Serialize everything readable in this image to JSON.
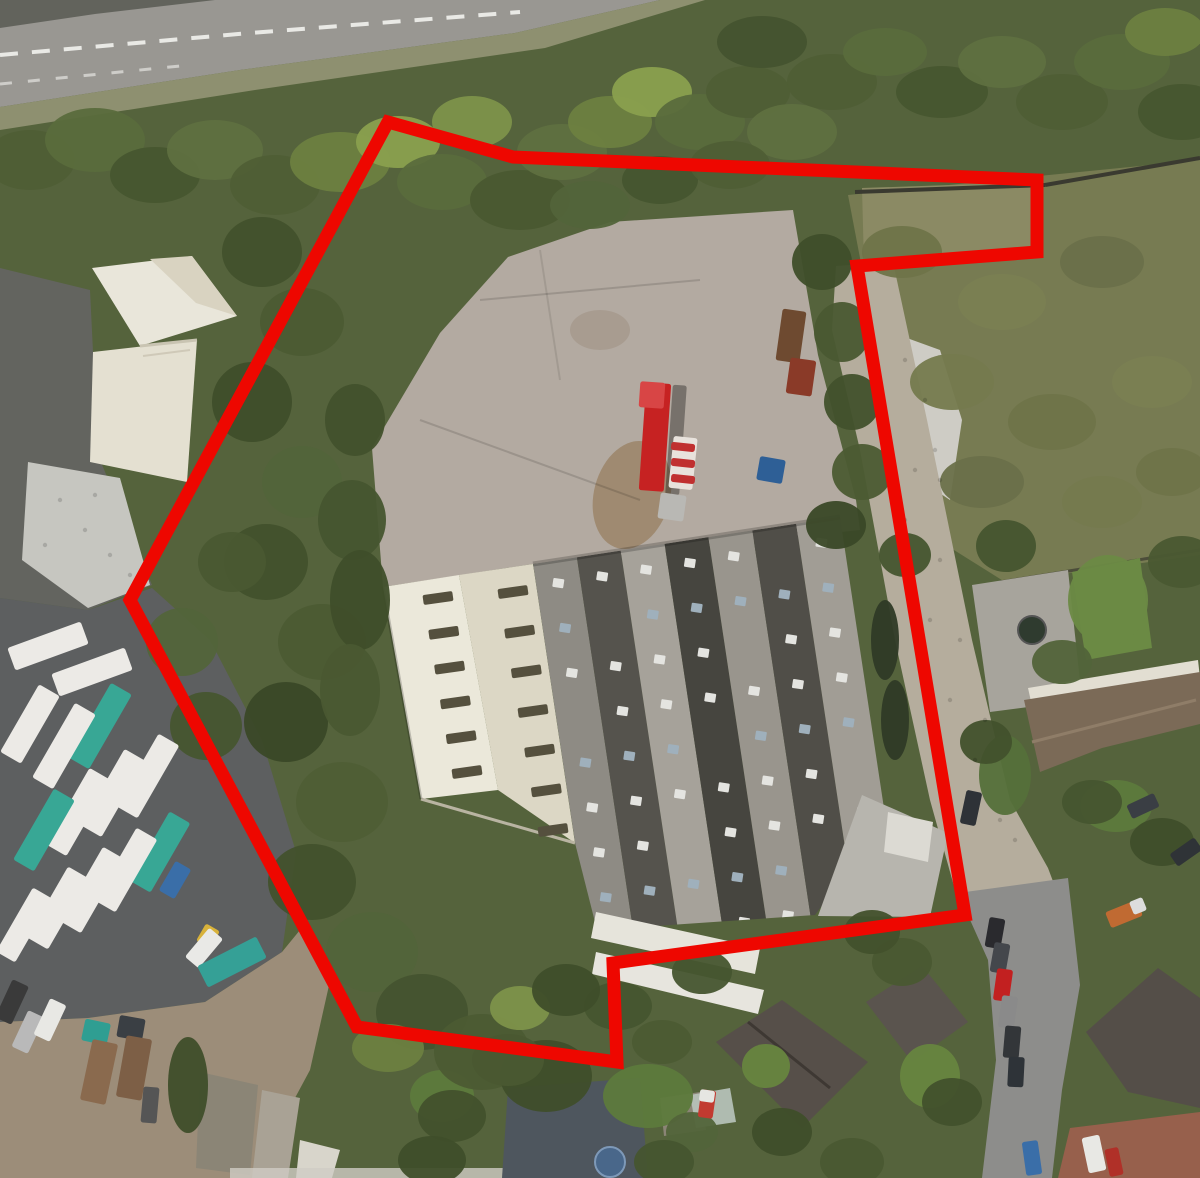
{
  "image": {
    "width": 1200,
    "height": 1178,
    "description": "Aerial satellite photograph of an industrial site with a large warehouse, concrete yard, truck depot and surrounding houses, outlined by a thick red site boundary polygon"
  },
  "colors": {
    "boundary": "#ee0700",
    "veg_base": "#55633c",
    "road": "#999792",
    "road_median": "#62635c",
    "verge": "#8e9070",
    "lane_marking": "#f2f2ee",
    "yard_concrete": "#b3aaa1",
    "yard_dirt": "#9b8569",
    "scrub": "#777b52",
    "notch_scrub": "#8b8a64",
    "wall_dark": "#3a3a30",
    "debris": "#ceccc5",
    "white_building": "#e9e6da",
    "white_building_shade": "#d9d3c1",
    "white_building_wing": "#e4e0d1",
    "asphalt_dark": "#63645f",
    "gravel": "#c6c6c0",
    "depot_ground": "#5d5f60",
    "dirt_yard": "#9c8d79",
    "cream_roof_1": "#ebe8da",
    "cream_roof_2": "#dcd7c5",
    "roof_vent": "#55503e",
    "annex_roof": "#b7b5ae",
    "annex_white": "#dcdad3",
    "awning_white": "#e6e4db",
    "driveway_cobble": "#b5ad9d",
    "right_road": "#8d8d8b",
    "patio": "#a7a49c",
    "lawn": "#6b8a44",
    "terrace_facade": "#e2ded2",
    "terrace_roof": "#7b6a57",
    "house_dark": "#564f49",
    "house_dark2": "#5a544e",
    "house_dark3": "#544e48",
    "house_blue": "#4e565e",
    "brown_roof": "#97604c",
    "white_walls": "#e7e5de",
    "shed": "#8b8576",
    "truck_white": "#eceae6",
    "truck_teal": "#38a795",
    "red_trailer": "#c62222"
  },
  "boundary": {
    "stroke_width": 13,
    "points": [
      [
        388,
        122
      ],
      [
        513,
        157
      ],
      [
        1037,
        180
      ],
      [
        1037,
        252
      ],
      [
        857,
        266
      ],
      [
        965,
        915
      ],
      [
        613,
        963
      ],
      [
        617,
        1062
      ],
      [
        357,
        1027
      ],
      [
        130,
        600
      ]
    ]
  },
  "road_markings": {
    "center_dashes": "0,55 250,33 520,12",
    "edge_dashes": "0,84 180,66"
  },
  "warehouse": {
    "gray_roof_outline": "533,564 840,517 900,800 815,915 597,930 575,843",
    "band_top_a": [
      533,
      564
    ],
    "band_top_b": [
      840,
      517
    ],
    "band_down": [
      61,
      404
    ],
    "band_colors": [
      "#8e8b84",
      "#55534d",
      "#a6a29a",
      "#46453f",
      "#99958d",
      "#504e48",
      "#a19d95"
    ],
    "skylights_per_band": 9,
    "skylight_colors": [
      "#e4e4e0",
      "#9fb0bc"
    ],
    "vents": [
      {
        "from": [
          438,
          598
        ],
        "to": [
          467,
          772
        ],
        "n": 6
      },
      {
        "from": [
          513,
          592
        ],
        "to": [
          553,
          830
        ],
        "n": 7
      }
    ]
  },
  "vegetation_blobs": [
    [
      1108,
      600,
      40,
      45,
      "#6b8a44"
    ],
    [
      648,
      1096,
      45,
      32,
      "#5d7a3c"
    ],
    [
      930,
      1076,
      30,
      32,
      "#67853f"
    ],
    [
      766,
      1066,
      24,
      22,
      "#67853f"
    ],
    [
      442,
      1096,
      32,
      26,
      "#5d7a3c"
    ],
    [
      1116,
      806,
      36,
      26,
      "#5d7a3c"
    ],
    [
      1005,
      775,
      26,
      40,
      "#55703a"
    ],
    [
      188,
      1085,
      20,
      48,
      "#3f4e2a"
    ],
    [
      30,
      160,
      45,
      30,
      "#4f5e35"
    ],
    [
      95,
      140,
      50,
      32,
      "#5a6b3c"
    ],
    [
      155,
      175,
      45,
      28,
      "#47562f"
    ],
    [
      215,
      150,
      48,
      30,
      "#5f7040"
    ],
    [
      275,
      185,
      45,
      30,
      "#4f5e35"
    ],
    [
      340,
      162,
      50,
      30,
      "#6d8040"
    ],
    [
      398,
      142,
      42,
      26,
      "#8aa04e"
    ],
    [
      442,
      182,
      45,
      28,
      "#5a6b3c"
    ],
    [
      472,
      122,
      40,
      26,
      "#7d924a"
    ],
    [
      520,
      200,
      50,
      30,
      "#4a5830"
    ],
    [
      562,
      152,
      45,
      28,
      "#5f7040"
    ],
    [
      610,
      122,
      42,
      26,
      "#6d8040"
    ],
    [
      652,
      92,
      40,
      25,
      "#8aa04e"
    ],
    [
      700,
      122,
      45,
      28,
      "#5a6b3c"
    ],
    [
      748,
      92,
      42,
      26,
      "#4f5e35"
    ],
    [
      792,
      132,
      45,
      28,
      "#5f7040"
    ],
    [
      762,
      42,
      45,
      26,
      "#44532f"
    ],
    [
      832,
      82,
      45,
      28,
      "#4f5e35"
    ],
    [
      885,
      52,
      42,
      24,
      "#5a6b3c"
    ],
    [
      942,
      92,
      46,
      26,
      "#47562f"
    ],
    [
      1002,
      62,
      44,
      26,
      "#5f7040"
    ],
    [
      1062,
      102,
      46,
      28,
      "#4f5e35"
    ],
    [
      1122,
      62,
      48,
      28,
      "#5a6b3c"
    ],
    [
      1182,
      112,
      44,
      28,
      "#47562f"
    ],
    [
      1165,
      32,
      40,
      24,
      "#6d8040"
    ],
    [
      590,
      205,
      40,
      24,
      "#52643a"
    ],
    [
      660,
      180,
      38,
      24,
      "#46552f"
    ],
    [
      730,
      165,
      40,
      24,
      "#4f5e35"
    ],
    [
      262,
      252,
      40,
      35,
      "#42512c"
    ],
    [
      302,
      322,
      42,
      34,
      "#4c5b33"
    ],
    [
      252,
      402,
      40,
      40,
      "#3f4e2a"
    ],
    [
      302,
      482,
      40,
      36,
      "#52643a"
    ],
    [
      266,
      562,
      42,
      38,
      "#42512c"
    ],
    [
      322,
      642,
      44,
      38,
      "#4c5b33"
    ],
    [
      286,
      722,
      42,
      40,
      "#3a4827"
    ],
    [
      342,
      802,
      46,
      40,
      "#4f5e35"
    ],
    [
      312,
      882,
      44,
      38,
      "#42512c"
    ],
    [
      372,
      952,
      46,
      40,
      "#52643a"
    ],
    [
      422,
      1012,
      46,
      38,
      "#44532f"
    ],
    [
      482,
      1052,
      48,
      38,
      "#4c5b33"
    ],
    [
      546,
      1076,
      46,
      36,
      "#3f4e2a"
    ],
    [
      182,
      642,
      36,
      34,
      "#52643a"
    ],
    [
      206,
      726,
      36,
      34,
      "#46552f"
    ],
    [
      232,
      562,
      34,
      30,
      "#4a5931"
    ],
    [
      352,
      520,
      34,
      40,
      "#46552f"
    ],
    [
      360,
      600,
      30,
      50,
      "#3f4e2a"
    ],
    [
      350,
      690,
      30,
      46,
      "#4a5931"
    ],
    [
      355,
      420,
      30,
      36,
      "#42512c"
    ],
    [
      388,
      1048,
      36,
      24,
      "#6d8040"
    ],
    [
      520,
      1008,
      30,
      22,
      "#7d924a"
    ],
    [
      822,
      262,
      30,
      28,
      "#3f4e2a"
    ],
    [
      842,
      332,
      28,
      30,
      "#4a5931"
    ],
    [
      852,
      402,
      28,
      28,
      "#42512c"
    ],
    [
      862,
      472,
      30,
      28,
      "#4c5b33"
    ],
    [
      836,
      525,
      30,
      24,
      "#3a4827"
    ],
    [
      905,
      555,
      26,
      22,
      "#46552f"
    ],
    [
      885,
      640,
      14,
      40,
      "#2f3a26"
    ],
    [
      895,
      720,
      14,
      40,
      "#2f3a26"
    ],
    [
      902,
      252,
      40,
      26,
      "#6f7449"
    ],
    [
      1002,
      302,
      44,
      28,
      "#7a7f52"
    ],
    [
      1102,
      262,
      42,
      26,
      "#6a704a"
    ],
    [
      952,
      382,
      42,
      28,
      "#757a4e"
    ],
    [
      1052,
      422,
      44,
      28,
      "#6f7449"
    ],
    [
      1152,
      382,
      40,
      26,
      "#7a7f52"
    ],
    [
      982,
      482,
      42,
      26,
      "#6a704a"
    ],
    [
      1102,
      502,
      40,
      26,
      "#757a4e"
    ],
    [
      1172,
      472,
      36,
      24,
      "#6f7449"
    ],
    [
      1006,
      546,
      30,
      26,
      "#46552f"
    ],
    [
      1182,
      562,
      34,
      26,
      "#4a5931"
    ],
    [
      1062,
      662,
      30,
      22,
      "#52643a"
    ],
    [
      986,
      742,
      26,
      22,
      "#42512c"
    ],
    [
      1092,
      802,
      30,
      22,
      "#46552f"
    ],
    [
      1162,
      842,
      32,
      24,
      "#3f4e2a"
    ],
    [
      902,
      962,
      30,
      24,
      "#4a5931"
    ],
    [
      872,
      932,
      28,
      22,
      "#42512c"
    ],
    [
      702,
      972,
      30,
      22,
      "#46552f"
    ],
    [
      782,
      1132,
      30,
      24,
      "#3f4e2a"
    ],
    [
      852,
      1162,
      32,
      24,
      "#4a5931"
    ],
    [
      952,
      1102,
      30,
      24,
      "#42512c"
    ],
    [
      692,
      1132,
      26,
      20,
      "#52643a"
    ],
    [
      662,
      1042,
      30,
      22,
      "#4c5b33"
    ],
    [
      618,
      1006,
      34,
      24,
      "#46552f"
    ],
    [
      566,
      990,
      34,
      26,
      "#3f4e2a"
    ],
    [
      508,
      1060,
      36,
      26,
      "#4a5931"
    ],
    [
      452,
      1116,
      34,
      26,
      "#42512c"
    ],
    [
      432,
      1160,
      34,
      24,
      "#3f4e2a"
    ],
    [
      664,
      1162,
      30,
      22,
      "#46552f"
    ]
  ],
  "vehicles": {
    "depot_trucks": [
      {
        "x": 48,
        "y": 646,
        "w": 78,
        "h": 24,
        "rot": -20,
        "color": "#eceae6",
        "name": "tanker-lorry"
      },
      {
        "x": 92,
        "y": 672,
        "w": 78,
        "h": 24,
        "rot": -20,
        "color": "#eceae6",
        "name": "tanker-lorry"
      },
      {
        "x": 100,
        "y": 726,
        "w": 24,
        "h": 86,
        "rot": 30,
        "color": "#38a795",
        "name": "tanker-lorry-teal"
      },
      {
        "x": 64,
        "y": 746,
        "w": 24,
        "h": 86,
        "rot": 30,
        "color": "#eceae6",
        "name": "tanker-lorry"
      },
      {
        "x": 30,
        "y": 724,
        "w": 24,
        "h": 78,
        "rot": 30,
        "color": "#eceae6",
        "name": "tanker-lorry"
      },
      {
        "x": 148,
        "y": 776,
        "w": 24,
        "h": 84,
        "rot": 30,
        "color": "#eceae6",
        "name": "tanker-lorry"
      },
      {
        "x": 113,
        "y": 793,
        "w": 24,
        "h": 88,
        "rot": 30,
        "color": "#eceae6",
        "name": "tanker-lorry"
      },
      {
        "x": 78,
        "y": 812,
        "w": 24,
        "h": 88,
        "rot": 30,
        "color": "#eceae6",
        "name": "tanker-lorry"
      },
      {
        "x": 44,
        "y": 830,
        "w": 24,
        "h": 82,
        "rot": 30,
        "color": "#38a795",
        "name": "tanker-lorry-teal"
      },
      {
        "x": 160,
        "y": 852,
        "w": 24,
        "h": 80,
        "rot": 30,
        "color": "#38a795",
        "name": "tanker-lorry-teal"
      },
      {
        "x": 126,
        "y": 870,
        "w": 24,
        "h": 84,
        "rot": 30,
        "color": "#eceae6",
        "name": "tanker-lorry"
      },
      {
        "x": 92,
        "y": 890,
        "w": 24,
        "h": 86,
        "rot": 30,
        "color": "#eceae6",
        "name": "tanker-lorry"
      },
      {
        "x": 58,
        "y": 908,
        "w": 24,
        "h": 82,
        "rot": 30,
        "color": "#eceae6",
        "name": "tanker-lorry"
      },
      {
        "x": 24,
        "y": 925,
        "w": 22,
        "h": 74,
        "rot": 30,
        "color": "#eceae6",
        "name": "tanker-lorry"
      },
      {
        "x": 175,
        "y": 880,
        "w": 18,
        "h": 34,
        "rot": 30,
        "color": "#3a6ea8",
        "name": "blue-lorry"
      },
      {
        "x": 208,
        "y": 936,
        "w": 16,
        "h": 20,
        "rot": 30,
        "color": "#d8b23a",
        "name": "yellow-plant"
      },
      {
        "x": 204,
        "y": 948,
        "w": 18,
        "h": 38,
        "rot": 40,
        "color": "#e9e9e6",
        "name": "white-van"
      }
    ],
    "dirt_yard_vehicles": [
      {
        "x": 96,
        "y": 1032,
        "w": 26,
        "h": 22,
        "rot": 12,
        "color": "#2f9e92",
        "name": "flatbed-cab"
      },
      {
        "x": 99,
        "y": 1072,
        "w": 26,
        "h": 62,
        "rot": 12,
        "color": "#8a6a4e",
        "name": "flatbed-bed"
      },
      {
        "x": 131,
        "y": 1028,
        "w": 26,
        "h": 22,
        "rot": 10,
        "color": "#3a3f44",
        "name": "flatbed-cab"
      },
      {
        "x": 134,
        "y": 1068,
        "w": 26,
        "h": 62,
        "rot": 10,
        "color": "#7d5f46",
        "name": "flatbed-bed"
      },
      {
        "x": 232,
        "y": 962,
        "w": 24,
        "h": 66,
        "rot": 63,
        "color": "#35a096",
        "name": "teal-flatbed"
      },
      {
        "x": 28,
        "y": 1032,
        "w": 18,
        "h": 40,
        "rot": 25,
        "color": "#b9b9b9",
        "name": "car-silver"
      },
      {
        "x": 50,
        "y": 1020,
        "w": 18,
        "h": 40,
        "rot": 25,
        "color": "#e8e8e4",
        "name": "car-white"
      },
      {
        "x": 12,
        "y": 1002,
        "w": 18,
        "h": 42,
        "rot": 25,
        "color": "#3a3a3a",
        "name": "car-dark"
      },
      {
        "x": 150,
        "y": 1105,
        "w": 16,
        "h": 36,
        "rot": 5,
        "color": "#555555",
        "name": "car-dark"
      }
    ],
    "site_vehicles": [
      {
        "x": 676,
        "y": 440,
        "w": 14,
        "h": 110,
        "rot": 4,
        "color": "#00000055",
        "name": "truck-shadow"
      },
      {
        "x": 655,
        "y": 437,
        "w": 25,
        "h": 108,
        "rot": 4,
        "color": "#c62222",
        "name": "red-articulated-trailer"
      },
      {
        "x": 652,
        "y": 395,
        "w": 25,
        "h": 26,
        "rot": 4,
        "color": "#d84545",
        "name": "red-trailer-front"
      },
      {
        "x": 683,
        "y": 463,
        "w": 24,
        "h": 52,
        "rot": 6,
        "color": "#e8e2dc",
        "name": "striped-unit"
      },
      {
        "x": 683,
        "y": 447,
        "w": 24,
        "h": 8,
        "rot": 6,
        "color": "#c03030",
        "name": "stripe"
      },
      {
        "x": 683,
        "y": 463,
        "w": 24,
        "h": 8,
        "rot": 6,
        "color": "#c03030",
        "name": "stripe"
      },
      {
        "x": 683,
        "y": 479,
        "w": 24,
        "h": 8,
        "rot": 6,
        "color": "#c03030",
        "name": "stripe"
      },
      {
        "x": 672,
        "y": 507,
        "w": 26,
        "h": 26,
        "rot": 8,
        "color": "#b9b8b4",
        "name": "truck-cab"
      },
      {
        "x": 771,
        "y": 470,
        "w": 26,
        "h": 24,
        "rot": 10,
        "color": "#2e5f96",
        "name": "blue-tarp"
      },
      {
        "x": 791,
        "y": 336,
        "w": 24,
        "h": 52,
        "rot": 8,
        "color": "#6e4a30",
        "name": "rusty-container"
      },
      {
        "x": 801,
        "y": 377,
        "w": 26,
        "h": 36,
        "rot": 8,
        "color": "#8a3a28",
        "name": "red-skip"
      }
    ],
    "street_cars": [
      {
        "x": 995,
        "y": 933,
        "w": 16,
        "h": 30,
        "rot": 10,
        "color": "#2a2a2e",
        "name": "car"
      },
      {
        "x": 1000,
        "y": 958,
        "w": 16,
        "h": 30,
        "rot": 10,
        "color": "#44474c",
        "name": "car"
      },
      {
        "x": 1003,
        "y": 985,
        "w": 16,
        "h": 32,
        "rot": 8,
        "color": "#c22020",
        "name": "car-red"
      },
      {
        "x": 1008,
        "y": 1012,
        "w": 16,
        "h": 32,
        "rot": 8,
        "color": "#8a8a8a",
        "name": "car"
      },
      {
        "x": 1012,
        "y": 1042,
        "w": 16,
        "h": 32,
        "rot": 5,
        "color": "#333639",
        "name": "car"
      },
      {
        "x": 1016,
        "y": 1072,
        "w": 16,
        "h": 30,
        "rot": 3,
        "color": "#2e3338",
        "name": "car"
      },
      {
        "x": 1032,
        "y": 1158,
        "w": 16,
        "h": 34,
        "rot": -8,
        "color": "#3a6ea8",
        "name": "car-blue"
      },
      {
        "x": 971,
        "y": 808,
        "w": 16,
        "h": 34,
        "rot": 12,
        "color": "#2e3237",
        "name": "car-driveway"
      },
      {
        "x": 1143,
        "y": 806,
        "w": 15,
        "h": 30,
        "rot": 65,
        "color": "#3a3e44",
        "name": "car"
      },
      {
        "x": 1186,
        "y": 852,
        "w": 15,
        "h": 30,
        "rot": 55,
        "color": "#2f3337",
        "name": "car"
      },
      {
        "x": 1124,
        "y": 914,
        "w": 17,
        "h": 34,
        "rot": 68,
        "color": "#c06a32",
        "name": "orange-truck"
      },
      {
        "x": 1138,
        "y": 906,
        "w": 14,
        "h": 14,
        "rot": 68,
        "color": "#dddddd",
        "name": "truck-cab"
      },
      {
        "x": 1094,
        "y": 1154,
        "w": 18,
        "h": 36,
        "rot": -12,
        "color": "#e8e8e4",
        "name": "white-van"
      },
      {
        "x": 1114,
        "y": 1162,
        "w": 14,
        "h": 28,
        "rot": -12,
        "color": "#b03028",
        "name": "car-red"
      },
      {
        "x": 707,
        "y": 1104,
        "w": 15,
        "h": 28,
        "rot": 8,
        "color": "#c23a30",
        "name": "car-red"
      },
      {
        "x": 707,
        "y": 1096,
        "w": 15,
        "h": 12,
        "rot": 8,
        "color": "#e6e6e2",
        "name": "car-roof"
      }
    ]
  },
  "scene_regions": [
    {
      "name": "dual-carriageway",
      "description": "Gray dual carriageway road with dashed white lane markings, top left"
    },
    {
      "name": "woodland-belt",
      "description": "Dense tree and scrub belt between road and site"
    },
    {
      "name": "concrete-yard",
      "description": "Large cracked concrete yard inside boundary"
    },
    {
      "name": "warehouse",
      "description": "Large multi-bay warehouse: cream gabled roofs on west side, gray roofs with rows of skylights on east side"
    },
    {
      "name": "truck-depot",
      "description": "Depot with rows of white and teal tanker lorries, bottom left"
    },
    {
      "name": "residential",
      "description": "Houses, gardens and parked cars along street, right and bottom"
    },
    {
      "name": "site-boundary",
      "description": "Thick red polygon marking the site boundary"
    }
  ]
}
